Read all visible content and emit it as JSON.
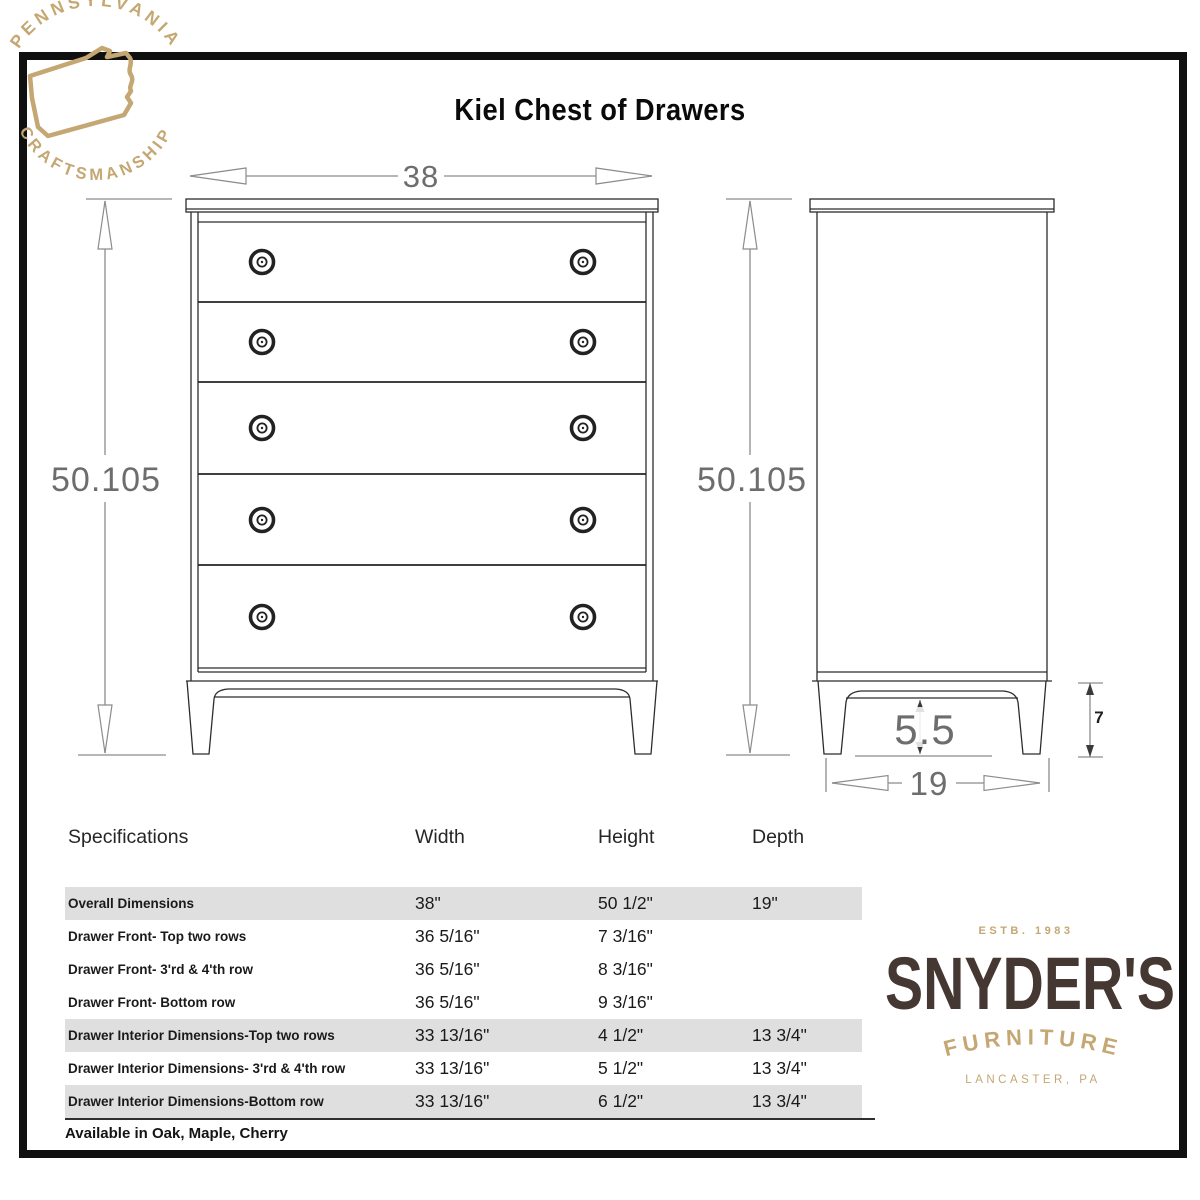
{
  "title": "Kiel Chest of Drawers",
  "badge": {
    "top_text": "PENNSYLVANIA",
    "bottom_text": "CRAFTSMANSHIP",
    "icon": "pennsylvania-state-outline",
    "gold": "#c4a772"
  },
  "drawing": {
    "front_view": {
      "width": "38",
      "height": "50.105",
      "drawer_count": 5
    },
    "side_view": {
      "height": "50.105",
      "base_clearance": "5.5",
      "depth": "19",
      "leg_height": "7"
    }
  },
  "table": {
    "headers": [
      "Specifications",
      "Width",
      "Height",
      "Depth"
    ],
    "rows": [
      {
        "label": "Overall Dimensions",
        "width": "38\"",
        "height": "50 1/2\"",
        "depth": "19\""
      },
      {
        "label": "Drawer Front- Top two rows",
        "width": "36 5/16\"",
        "height": "7 3/16\"",
        "depth": ""
      },
      {
        "label": "Drawer Front- 3'rd & 4'th row",
        "width": "36 5/16\"",
        "height": "8 3/16\"",
        "depth": ""
      },
      {
        "label": "Drawer Front- Bottom row",
        "width": "36 5/16\"",
        "height": "9 3/16\"",
        "depth": ""
      },
      {
        "label": "Drawer Interior Dimensions-Top two rows",
        "width": "33 13/16\"",
        "height": "4 1/2\"",
        "depth": "13 3/4\""
      },
      {
        "label": "Drawer Interior Dimensions- 3'rd & 4'th row",
        "width": "33 13/16\"",
        "height": "5 1/2\"",
        "depth": "13 3/4\""
      },
      {
        "label": "Drawer Interior Dimensions-Bottom row",
        "width": "33 13/16\"",
        "height": "6 1/2\"",
        "depth": "13 3/4\""
      }
    ],
    "footer": "Available in Oak, Maple, Cherry"
  },
  "brand": {
    "estb": "ESTB. 1983",
    "name": "SNYDER'S",
    "line": "FURNITURE",
    "location": "LANCASTER, PA",
    "brown": "#453731",
    "gold": "#c4a772"
  }
}
